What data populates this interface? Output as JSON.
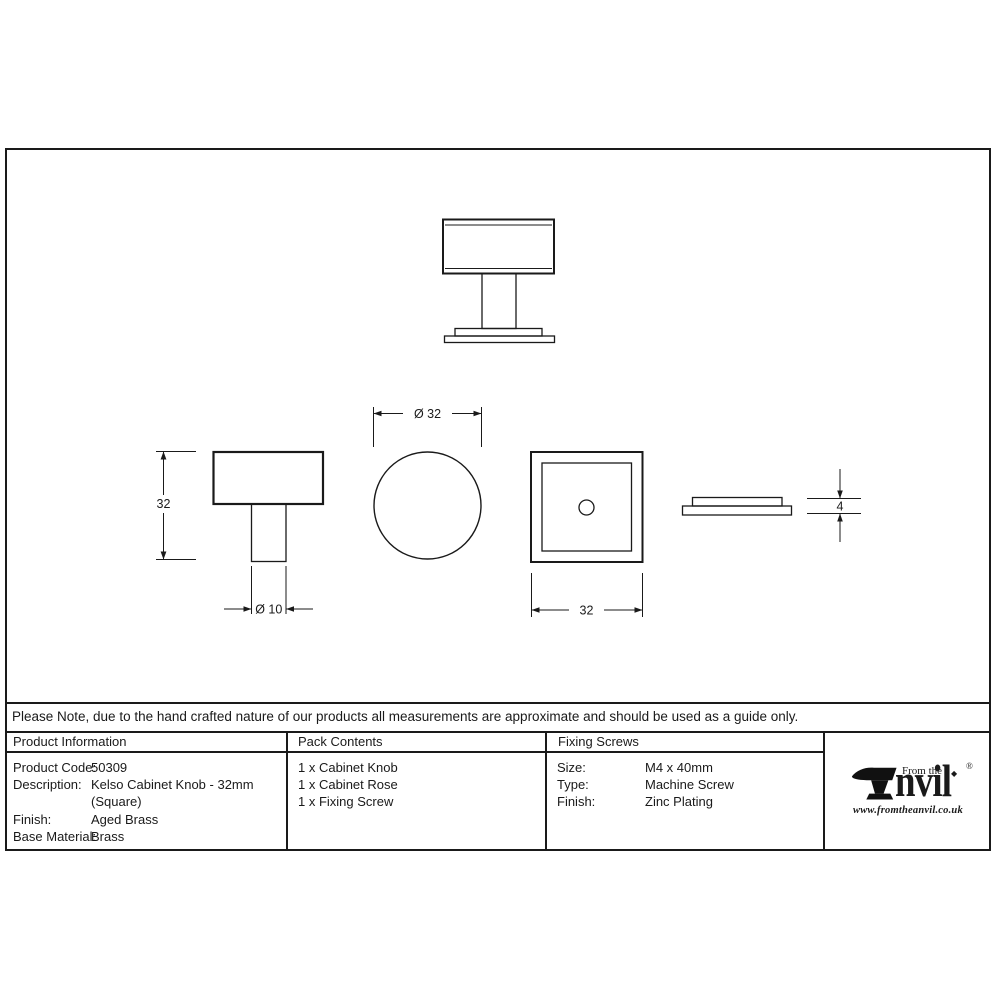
{
  "note": "Please Note, due to the hand crafted nature of our products all measurements are approximate and should be used as a guide only.",
  "drawing": {
    "dimensions": {
      "knob_height": "32",
      "stem_diameter": "Ø 10",
      "knob_diameter": "Ø 32",
      "rose_width": "32",
      "rose_thickness": "4"
    }
  },
  "table": {
    "product_information": {
      "header": "Product Information",
      "rows": [
        {
          "label": "Product Code:",
          "value": "50309"
        },
        {
          "label": "Description:",
          "value": "Kelso Cabinet Knob - 32mm"
        },
        {
          "label": "",
          "value": "(Square)"
        },
        {
          "label": "Finish:",
          "value": "Aged Brass"
        },
        {
          "label": "Base Material:",
          "value": "Brass"
        }
      ]
    },
    "pack_contents": {
      "header": "Pack Contents",
      "items": [
        "1 x Cabinet Knob",
        "1 x Cabinet Rose",
        "1 x Fixing Screw"
      ]
    },
    "fixing_screws": {
      "header": "Fixing Screws",
      "rows": [
        {
          "label": "Size:",
          "value": "M4 x 40mm"
        },
        {
          "label": "Type:",
          "value": "Machine Screw"
        },
        {
          "label": "Finish:",
          "value": "Zinc Plating"
        }
      ]
    }
  },
  "logo": {
    "tagline": "From the",
    "brand_suffix": "nvil",
    "registered": "®",
    "dot": "◆",
    "website": "www.fromtheanvil.co.uk"
  },
  "colors": {
    "line": "#1a1a1a",
    "background": "#ffffff"
  }
}
